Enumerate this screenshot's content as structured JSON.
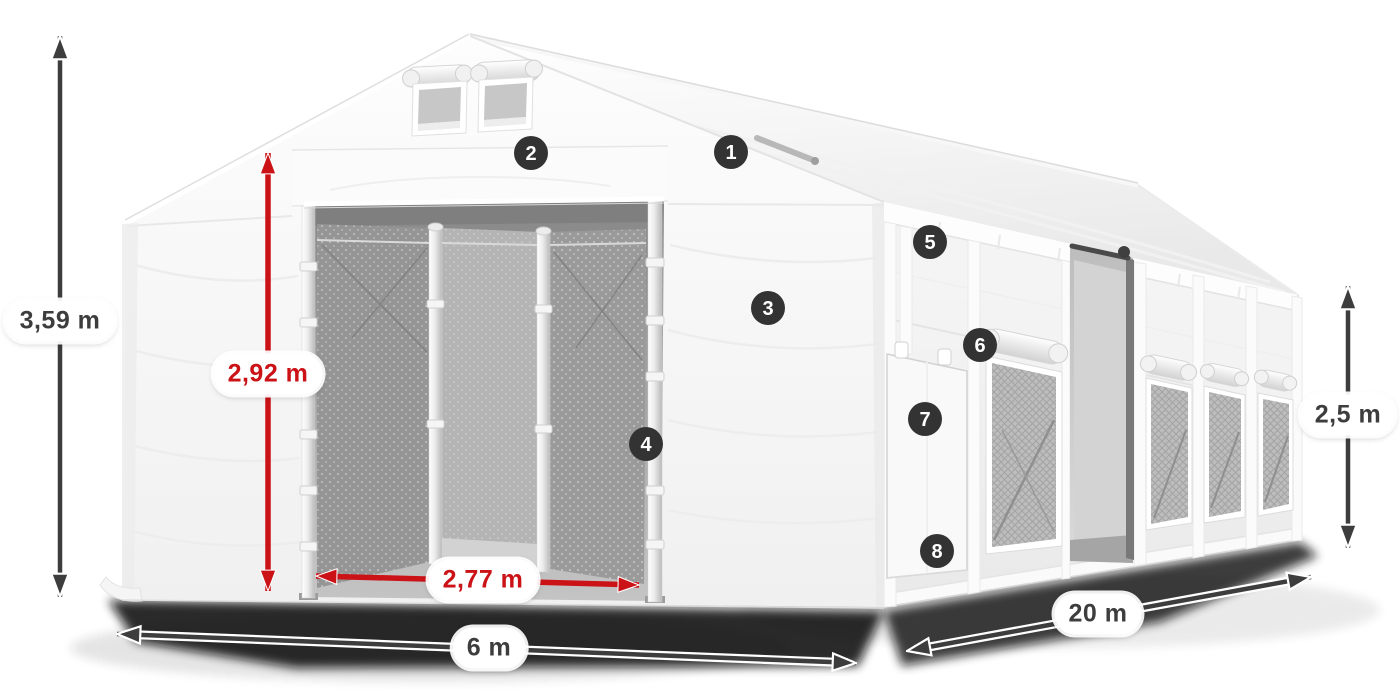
{
  "diagram": {
    "dimensions": {
      "total_height": "3,59 m",
      "entrance_height": "2,92 m",
      "entrance_width": "2,77 m",
      "front_width": "6 m",
      "side_length": "20 m",
      "side_wall_height": "2,5 m"
    },
    "badges": [
      {
        "number": "1"
      },
      {
        "number": "2"
      },
      {
        "number": "3"
      },
      {
        "number": "4"
      },
      {
        "number": "5"
      },
      {
        "number": "6"
      },
      {
        "number": "7"
      },
      {
        "number": "8"
      }
    ],
    "colors": {
      "dimension_red": "#cb1217",
      "dimension_dark": "#3d3d3d",
      "badge_background": "#333333",
      "label_background": "#ffffff"
    }
  }
}
